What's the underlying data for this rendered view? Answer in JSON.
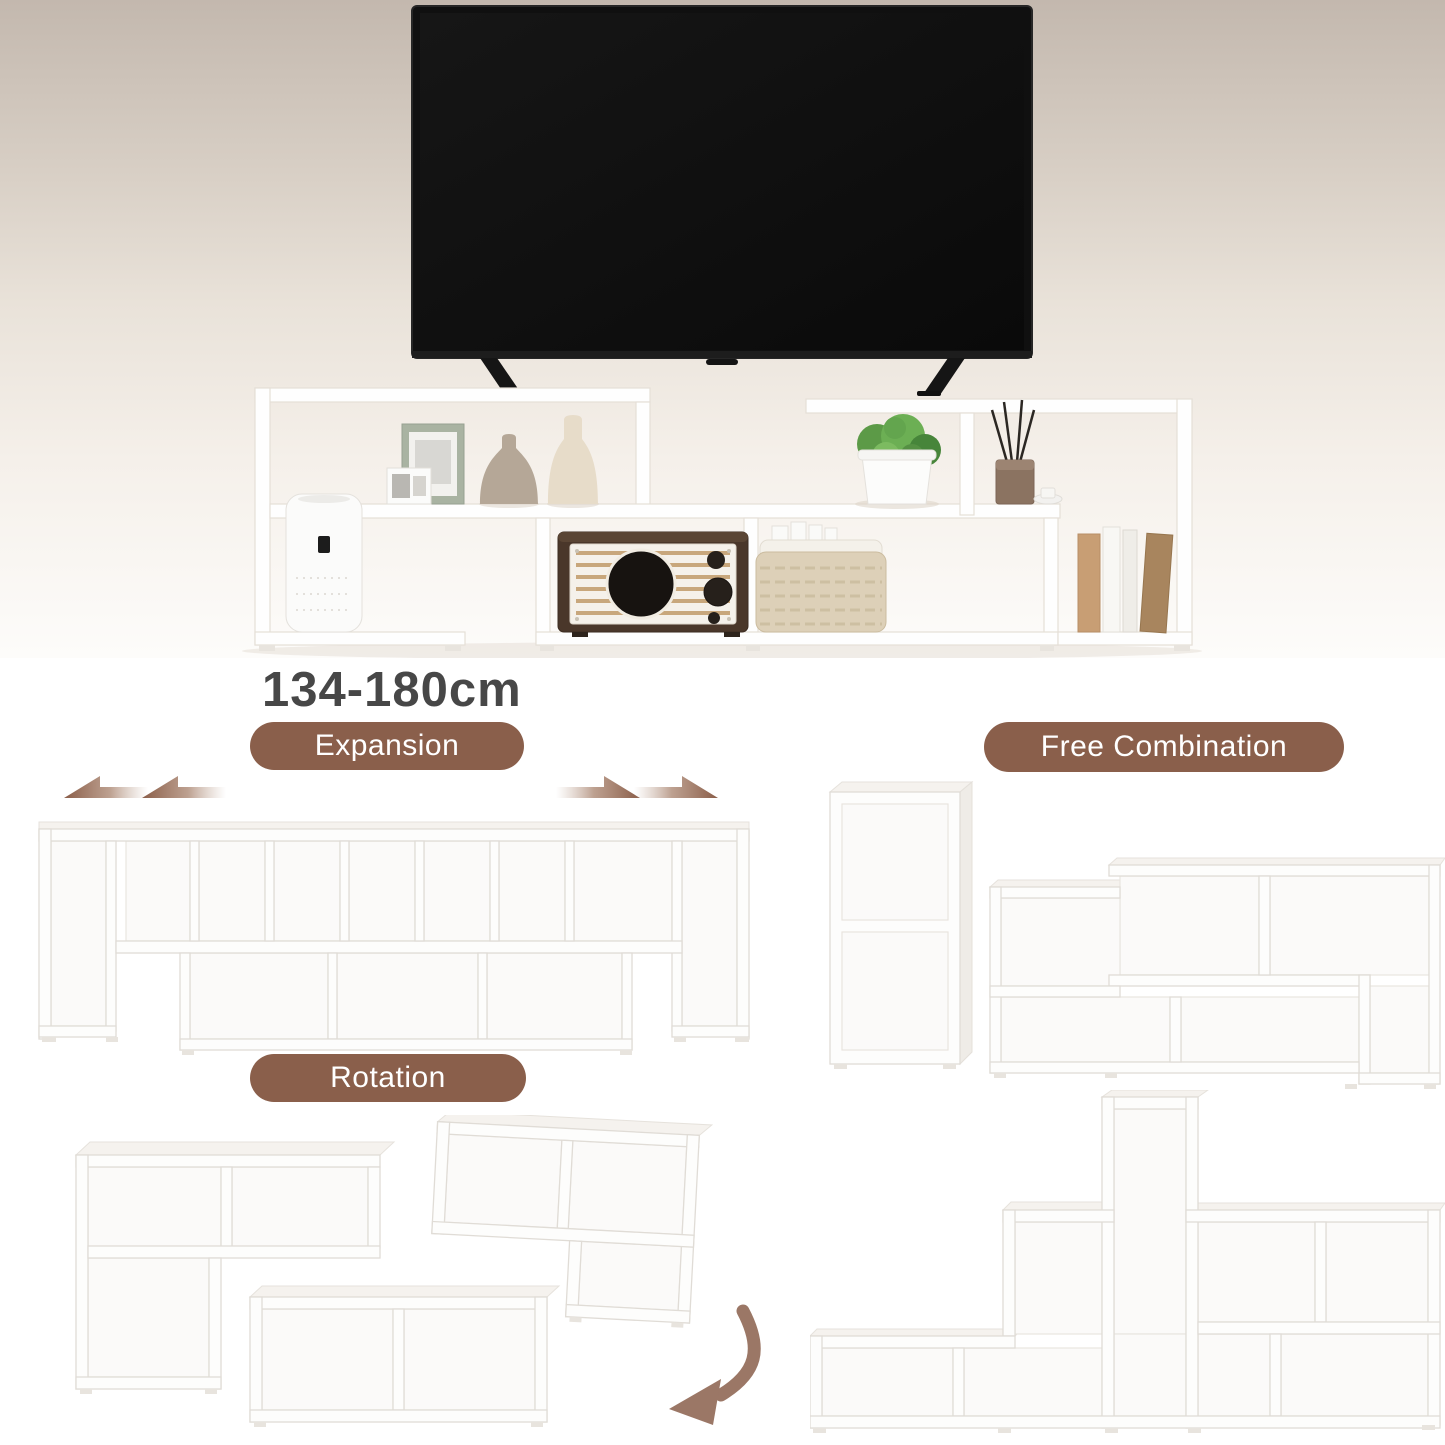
{
  "size_label": "134-180cm",
  "sections": {
    "expansion": {
      "label": "Expansion"
    },
    "free_combination": {
      "label": "Free Combination"
    },
    "rotation": {
      "label": "Rotation"
    }
  },
  "hero": {
    "objects": [
      "tv",
      "tv-stand-shelf",
      "air-purifier",
      "picture-frames",
      "vases",
      "potted-plant",
      "incense-sticks",
      "candle-dish",
      "upright-books",
      "retro-radio",
      "storage-basket"
    ]
  },
  "icons": {
    "expansion_arrows_left": "double-arrow-left",
    "expansion_arrows_right": "double-arrow-right",
    "rotation_arrow": "curved-arrow-down-left"
  },
  "colors": {
    "badge_bg": "#8a5f4b",
    "badge_text": "#ffffff",
    "heading_text": "#474747",
    "arrow_brown": "#9b7766",
    "hero_bg_top": "#c3b8ae",
    "hero_bg_mid": "#e9e2d9",
    "hero_bg_bottom": "#fdfcfa",
    "page_bg": "#ffffff"
  }
}
